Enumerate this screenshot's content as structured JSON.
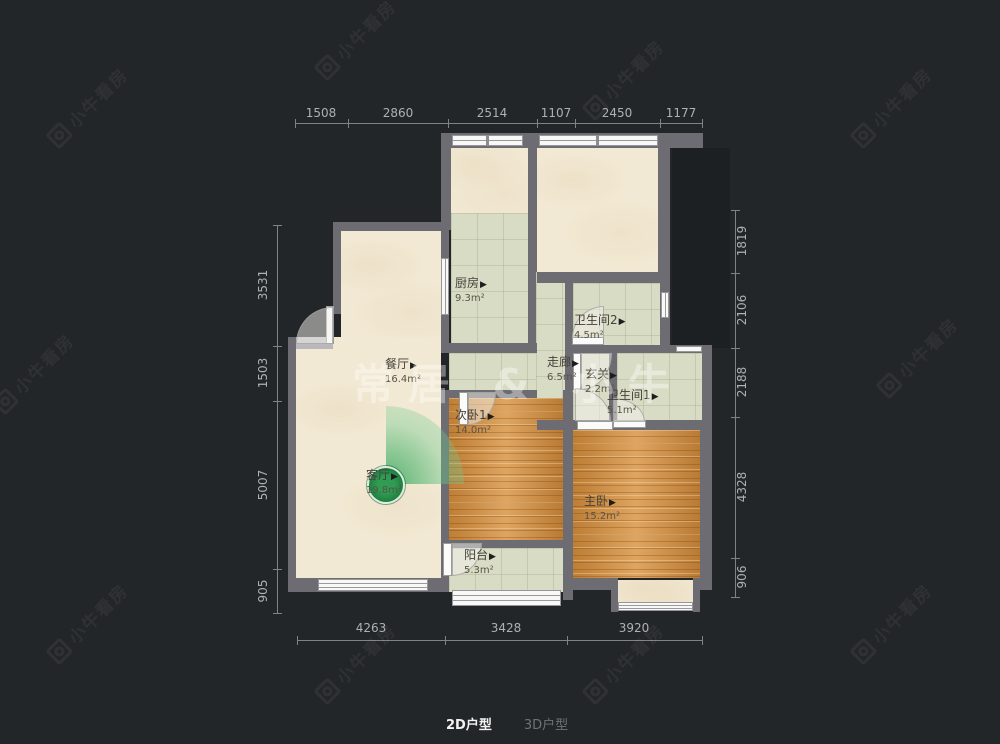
{
  "watermark": {
    "brand": "小牛看房",
    "center": "常居 & 小牛"
  },
  "toggle": {
    "d2": "2D户型",
    "d3": "3D户型"
  },
  "ui": {
    "arrow": "▶"
  },
  "rooms": {
    "kitchen": {
      "name": "厨房",
      "area": "9.3m²"
    },
    "dining": {
      "name": "餐厅",
      "area": "16.4m²"
    },
    "living": {
      "name": "客厅",
      "area": "19.8m²"
    },
    "corridor": {
      "name": "走廊",
      "area": "6.5m²"
    },
    "entry": {
      "name": "玄关",
      "area": "2.2m²"
    },
    "bath2": {
      "name": "卫生间2",
      "area": "4.5m²"
    },
    "bath1": {
      "name": "卫生间1",
      "area": "5.1m²"
    },
    "bedroom2": {
      "name": "次卧1",
      "area": "14.0m²"
    },
    "master": {
      "name": "主卧",
      "area": "15.2m²"
    },
    "balcony": {
      "name": "阳台",
      "area": "5.3m²"
    }
  },
  "dims": {
    "top": [
      "1508",
      "2860",
      "2514",
      "1107",
      "2450",
      "1177"
    ],
    "left": [
      "3531",
      "1503",
      "5007",
      "905"
    ],
    "right": [
      "1819",
      "2106",
      "2188",
      "4328",
      "906"
    ],
    "bottom": [
      "4263",
      "3428",
      "3920"
    ]
  },
  "colors": {
    "background": "#232629",
    "wall": "#6c6c72",
    "floor_cream": "#f2e9d4",
    "floor_tile": "#d9dcc4",
    "floor_wood": "#d38c3b",
    "vr_green": "#2f9c52",
    "dim_text": "#acb1b4"
  }
}
